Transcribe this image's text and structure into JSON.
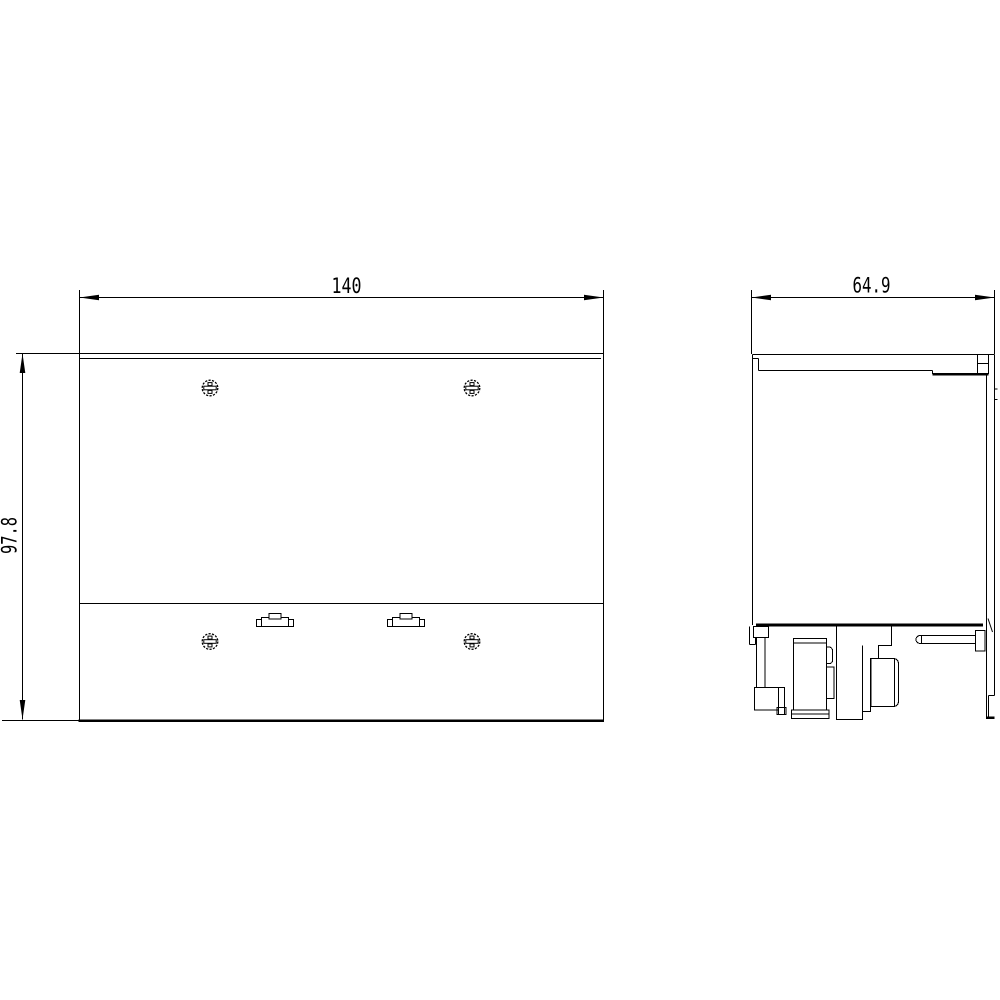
{
  "drawing": {
    "type": "technical-dimension-drawing",
    "colors": {
      "line": "#000000",
      "background": "#ffffff",
      "text": "#000000"
    },
    "dimensions": {
      "width": {
        "label": "140"
      },
      "height": {
        "label": "97.8"
      },
      "depth": {
        "label": "64.9"
      }
    },
    "front_view": {
      "screw_count": 4,
      "clip_count": 2
    },
    "side_view": {
      "feature": "din-rail-clip-assembly"
    }
  }
}
